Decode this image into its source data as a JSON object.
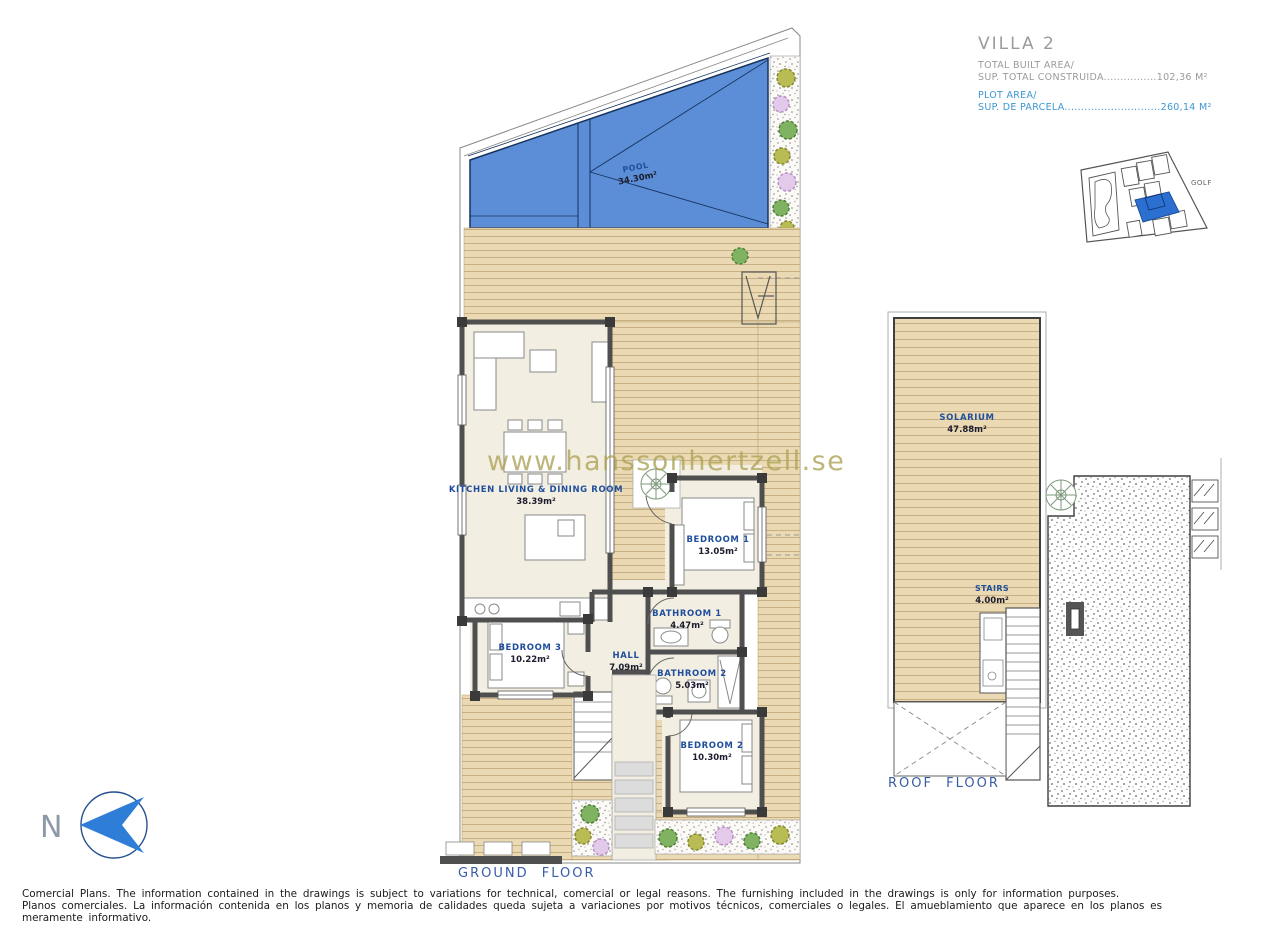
{
  "title_block": {
    "villa": "VILLA 2",
    "built_area_label": "TOTAL BUILT AREA/",
    "built_area_line": "SUP. TOTAL CONSTRUIDA................102,36 M²",
    "plot_area_label": "PLOT AREA/",
    "plot_area_line": "SUP. DE PARCELA.............................260,14 M²"
  },
  "site_map": {
    "golf_label": "GOLF"
  },
  "ground_floor": {
    "caption": "GROUND FLOOR",
    "rooms": [
      {
        "name": "POOL",
        "area": "34.30m²"
      },
      {
        "name": "KITCHEN LIVING & DINING ROOM",
        "area": "38.39m²"
      },
      {
        "name": "BEDROOM 1",
        "area": "13.05m²"
      },
      {
        "name": "BEDROOM 3",
        "area": "10.22m²"
      },
      {
        "name": "HALL",
        "area": "7.09m²"
      },
      {
        "name": "BATHROOM 1",
        "area": "4.47m²"
      },
      {
        "name": "BATHROOM 2",
        "area": "5.03m²"
      },
      {
        "name": "BEDROOM 2",
        "area": "10.30m²"
      }
    ]
  },
  "roof_floor": {
    "caption": "ROOF FLOOR",
    "rooms": [
      {
        "name": "SOLARIUM",
        "area": "47.88m²"
      },
      {
        "name": "STAIRS",
        "area": "4.00m²"
      }
    ]
  },
  "watermark": "www.hanssonhertzell.se",
  "north_label": "N",
  "disclaimer": {
    "line1": "Comercial Plans. The information contained in the drawings is subject to variations for technical, comercial or legal reasons. The furnishing included in the drawings is only for information purposes.",
    "line2": "Planos comerciales. La información contenida en los planos y memoria de calidades queda sujeta a variaciones por motivos técnicos, comerciales o legales. El amueblamiento que aparece en los planos es meramente informativo."
  },
  "colors": {
    "pool_blue": "#5b8ed6",
    "pool_line": "#16335e",
    "deck_wood": "#ead9b2",
    "deck_line": "#c6b083",
    "room_floor": "#f3eee2",
    "wall": "#4f4f4f",
    "room_label_blue": "#1f4e9c",
    "title_gray": "#9b9b9b",
    "title_blue": "#3d96d2",
    "watermark_olive": "#aca258",
    "caption_blue": "#3a5da8",
    "north_arrow_blue": "#2e7ed8",
    "site_map_plot_blue": "#2b6fd0"
  }
}
